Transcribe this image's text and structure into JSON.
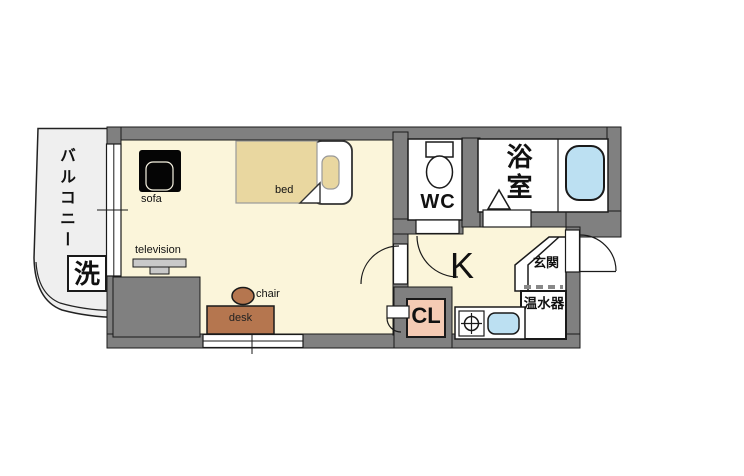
{
  "plan": {
    "balcony": {
      "label": "バルコニー"
    },
    "laundry": {
      "label": "洗"
    },
    "living_room": {
      "sofa_label": "sofa",
      "bed_label": "bed",
      "television_label": "television",
      "chair_label": "chair",
      "desk_label": "desk"
    },
    "wc": {
      "label": "WC"
    },
    "bathroom": {
      "label": "浴室"
    },
    "kitchen": {
      "label": "K"
    },
    "closet": {
      "label": "CL"
    },
    "entrance": {
      "label": "玄関"
    },
    "water_heater": {
      "label": "温水器"
    }
  },
  "colors": {
    "wall_gray": "#808080",
    "floor_cream": "#FBF5DA",
    "balcony_gray": "#EFEFEF",
    "water_blue": "#BCE0F2",
    "closet_pink": "#F5CBB4",
    "furniture_brown": "#B5764F",
    "bed_tan": "#E9D7A0",
    "tv_gray": "#C9C9C9"
  }
}
